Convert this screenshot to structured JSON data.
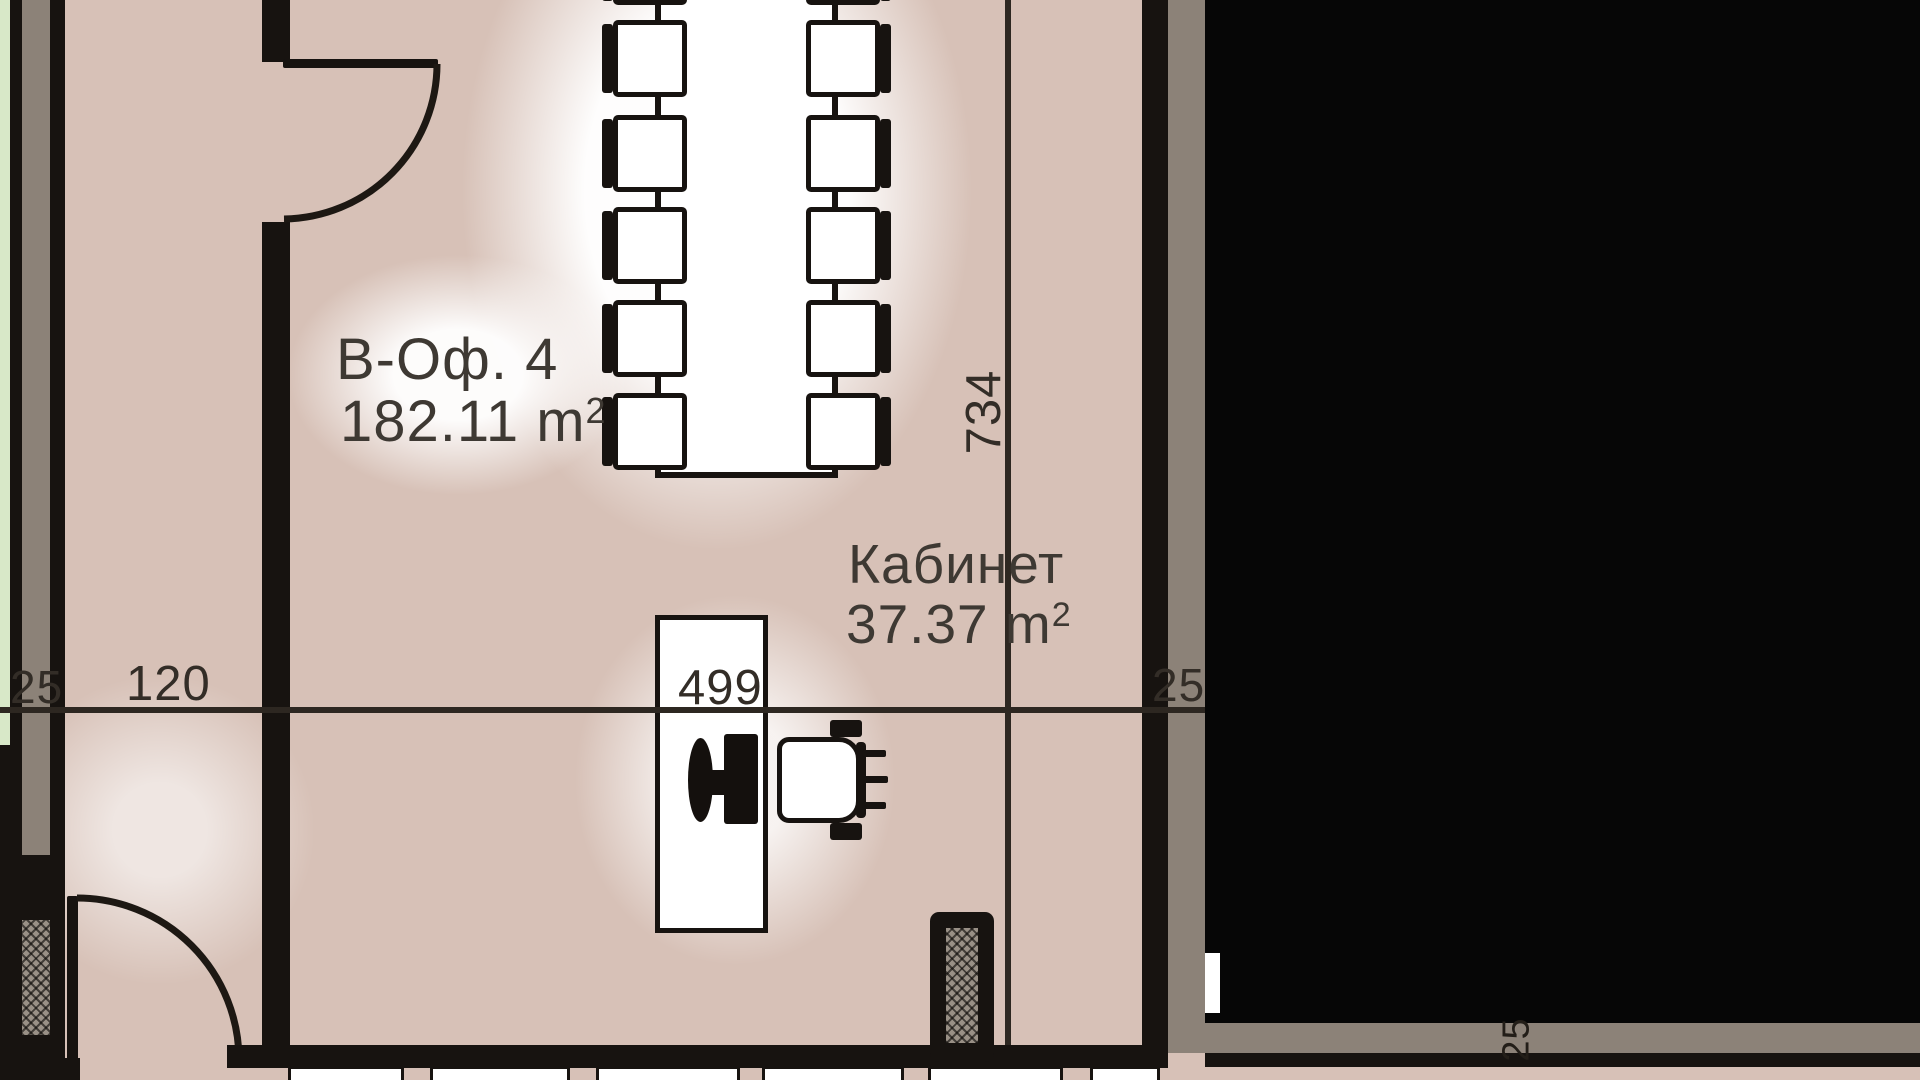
{
  "meta": {
    "type": "architectural-floor-plan",
    "language": "bg"
  },
  "rooms": [
    {
      "id": "office-b4",
      "name": "В-Оф. 4",
      "area_text": "182.11 m",
      "area_sup": "2"
    },
    {
      "id": "cabinet",
      "name": "Кабинет",
      "area_text": "37.37 m",
      "area_sup": "2"
    }
  ],
  "dims": {
    "corridor": "120",
    "desk_line": "499",
    "room_depth": "734",
    "wall_left": "25",
    "wall_right": "25",
    "wall_bottom_right": "25"
  },
  "furniture": {
    "conference_table": "conference-table",
    "conference_chairs": "conference-chair x10 (2 columns of 5, plus cut-off row at top)",
    "desk": "desk",
    "computer": "monitor-icon",
    "office_chair": "office-chair",
    "shaft": "hatched-shaft-column",
    "doors": "door-swing-arc x2",
    "windows": "window-band-bottom"
  },
  "colors": {
    "floor": "#d7c1b7",
    "wall": "#171310",
    "wall_cavity_gray": "#8c8278",
    "adjacent_room_green": "#d8e8c8",
    "furniture_fill": "#ffffff",
    "label_text": "#3e3933",
    "dimension_text": "#332d27",
    "masked_area": "#060606"
  }
}
